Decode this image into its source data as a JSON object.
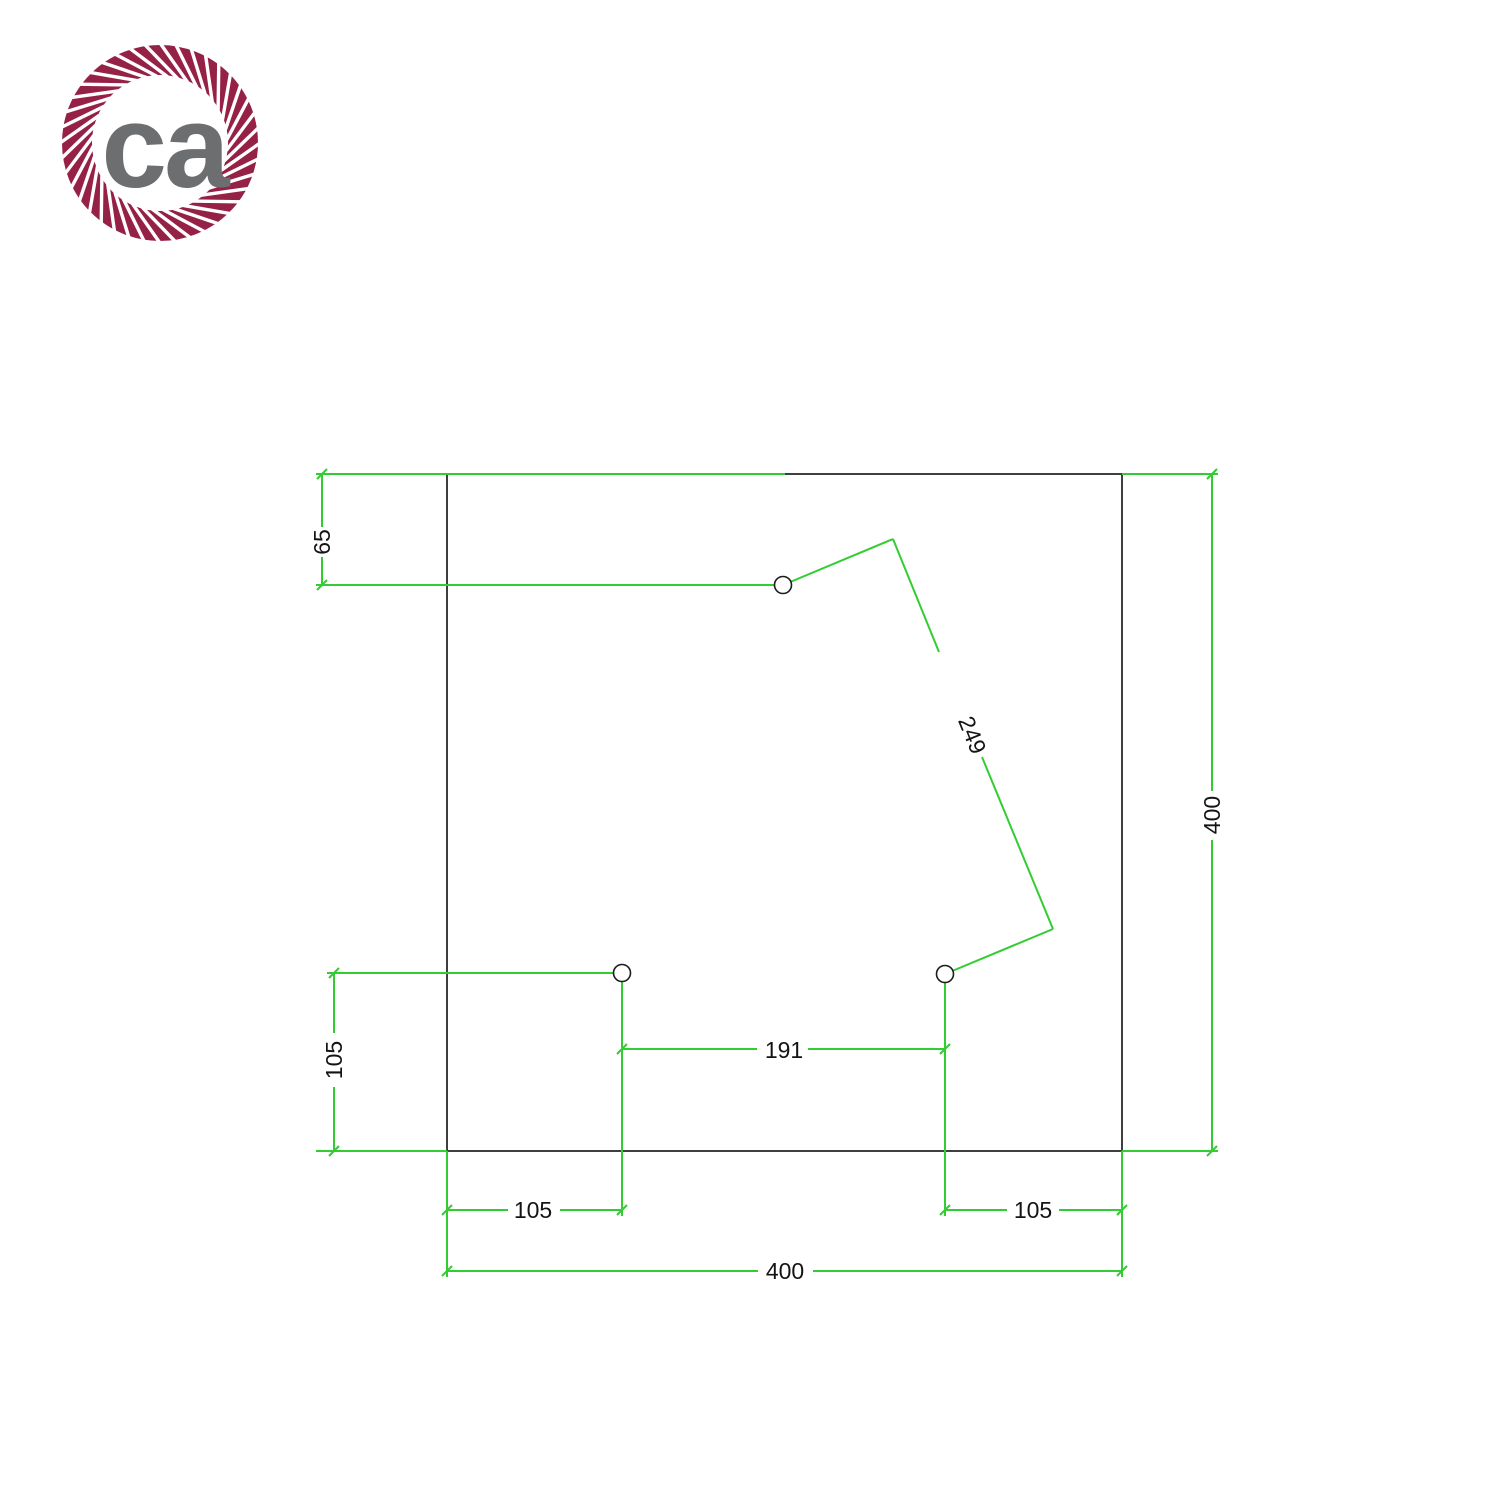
{
  "logo": {
    "text": "ca"
  },
  "colors": {
    "background": "#ffffff",
    "rope": "#962147",
    "logo_text": "#6d6e70",
    "dimension_line": "#33cc33",
    "outline": "#3f3f3f",
    "dimension_text": "#141414"
  },
  "drawing": {
    "dimensions": {
      "top_hole_offset": "65",
      "diagonal_hole_spacing": "249",
      "side_height": "400",
      "left_hole_vertical_offset": "105",
      "bottom_holes_spacing": "191",
      "bottom_left_hole_offset": "105",
      "bottom_right_hole_offset": "105",
      "bottom_side_width": "400"
    }
  }
}
